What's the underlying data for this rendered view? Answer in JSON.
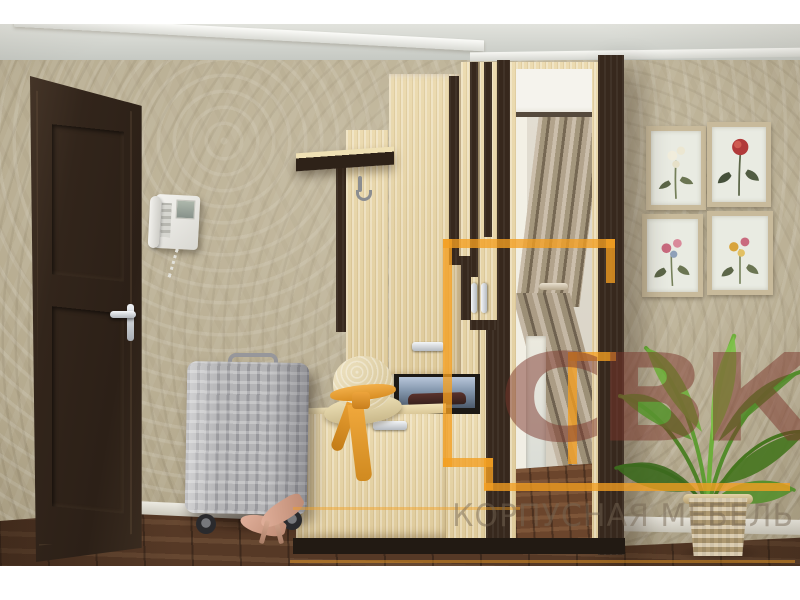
{
  "scene": {
    "description": "3D product photo of a hallway furniture set (entryway wardrobe with mirror) in a room",
    "objects": [
      "entrance-door",
      "wall-intercom",
      "botanical-pictures",
      "hallway-wardrobe",
      "coat-hook-panel",
      "mirror-door",
      "open-niche-with-backlight",
      "shoe-cabinet",
      "straw-hat",
      "silver-suitcase",
      "high-heel-shoes",
      "palm-plant",
      "wicker-basket"
    ]
  },
  "watermark": {
    "logo": "СВК",
    "tagline": "КОРПУСНАЯ МЕБЕЛЬ",
    "logo_outline_color": "#f39f21",
    "logo_letters_color": "#7c352b",
    "tagline_color": "#766653"
  },
  "palette": {
    "wallpaper": "#b3a88c",
    "ceiling": "#d5d7d1",
    "floor": "#573926",
    "door_wenge": "#32251b",
    "furniture_beech": "#e9d6a6",
    "furniture_wenge": "#37281d",
    "handle_silver": "#c9ccd2",
    "niche_backlight": "#8396ac",
    "hat_ribbon_orange": "#e8a033",
    "plant_green": "#5f9c33",
    "suitcase_silver": "#b4b4b6"
  }
}
